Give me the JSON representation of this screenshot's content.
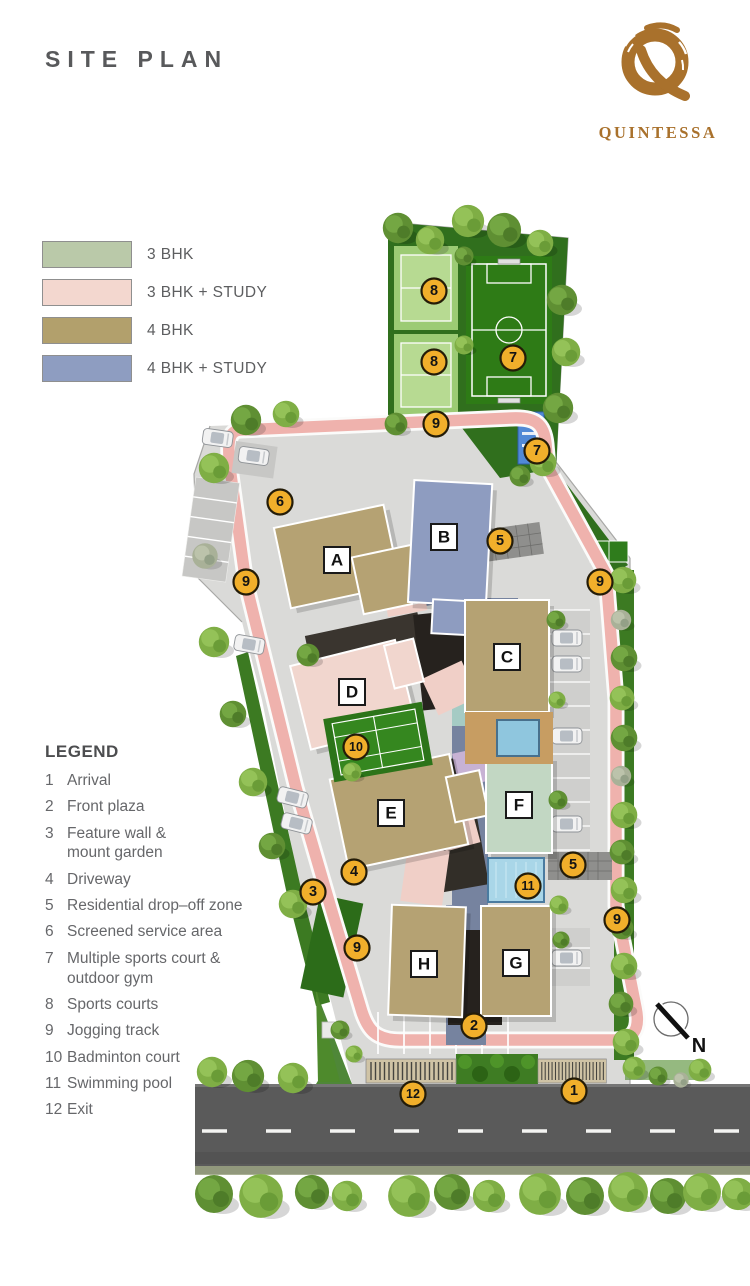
{
  "page": {
    "title": "SITE PLAN"
  },
  "brand": {
    "name": "QUINTESSA",
    "logo_color": "#a9712c"
  },
  "unit_legend": {
    "items": [
      {
        "label": "3 BHK",
        "color": "#bac9a9"
      },
      {
        "label": "3 BHK + STUDY",
        "color": "#f3d7cf"
      },
      {
        "label": "4 BHK",
        "color": "#b2a06c"
      },
      {
        "label": "4 BHK + STUDY",
        "color": "#8e9dc1"
      }
    ]
  },
  "legend": {
    "title": "LEGEND",
    "items": [
      {
        "num": "1",
        "label": "Arrival"
      },
      {
        "num": "2",
        "label": "Front plaza"
      },
      {
        "num": "3",
        "label": "Feature wall &",
        "label2": "mount garden"
      },
      {
        "num": "4",
        "label": "Driveway"
      },
      {
        "num": "5",
        "label": "Residential drop–off zone"
      },
      {
        "num": "6",
        "label": "Screened service area"
      },
      {
        "num": "7",
        "label": "Multiple sports court &",
        "label2": "outdoor gym"
      },
      {
        "num": "8",
        "label": "Sports courts"
      },
      {
        "num": "9",
        "label": "Jogging track"
      },
      {
        "num": "10",
        "label": "Badminton court"
      },
      {
        "num": "11",
        "label": "Swimming pool"
      },
      {
        "num": "12",
        "label": "Exit"
      }
    ]
  },
  "plan": {
    "colors": {
      "marker": "#f1af2b",
      "track": "#efb2ad",
      "ground": "#dadad8",
      "grass": "#306f1d",
      "building_4bhk": "#b5a273",
      "building_4bhk_study": "#8e9cc0",
      "building_3bhk_study": "#f1d6ce",
      "building_3bhk": "#c2d7c3",
      "pool": "#a9d6e8",
      "road": "#5a5a5a"
    },
    "buildings": [
      {
        "letter": "A"
      },
      {
        "letter": "B"
      },
      {
        "letter": "C"
      },
      {
        "letter": "D"
      },
      {
        "letter": "E"
      },
      {
        "letter": "F"
      },
      {
        "letter": "G"
      },
      {
        "letter": "H"
      }
    ],
    "markers": [
      {
        "n": "1"
      },
      {
        "n": "2"
      },
      {
        "n": "3"
      },
      {
        "n": "4"
      },
      {
        "n": "5"
      },
      {
        "n": "5"
      },
      {
        "n": "6"
      },
      {
        "n": "7"
      },
      {
        "n": "7"
      },
      {
        "n": "8"
      },
      {
        "n": "8"
      },
      {
        "n": "9"
      },
      {
        "n": "9"
      },
      {
        "n": "9"
      },
      {
        "n": "9"
      },
      {
        "n": "9"
      },
      {
        "n": "10"
      },
      {
        "n": "11"
      },
      {
        "n": "12"
      }
    ],
    "compass_label": "N"
  }
}
